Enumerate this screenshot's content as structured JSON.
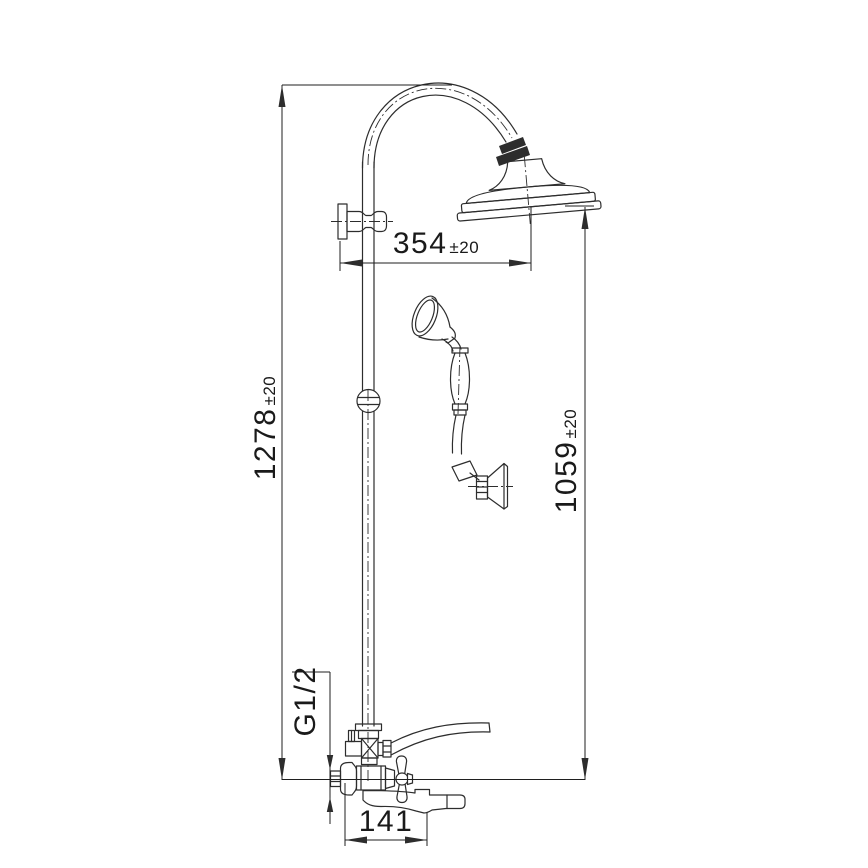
{
  "drawing": {
    "background_color": "#ffffff",
    "line_color": "#2d2d2d",
    "dim_color": "#1f1f1f",
    "text_color": "#1a1a1a"
  },
  "dimensions": {
    "overall_height": {
      "value": "1278",
      "tolerance": "±20"
    },
    "head_height": {
      "value": "1059",
      "tolerance": "±20"
    },
    "head_reach": {
      "value": "354",
      "tolerance": "±20"
    },
    "spout_reach": {
      "value": "141",
      "tolerance": ""
    },
    "connection_thread": {
      "value": "G1/2",
      "tolerance": ""
    }
  },
  "components": [
    "riser-pipe",
    "gooseneck-arch",
    "swivel-nut",
    "rain-shower-head",
    "wall-bracket",
    "pipe-ball-joint",
    "hand-shower",
    "shower-hose",
    "hand-shower-holder",
    "diverter-tee",
    "hose-connection",
    "mixer-valve-body",
    "wall-connection",
    "cross-handle",
    "tub-spout"
  ]
}
